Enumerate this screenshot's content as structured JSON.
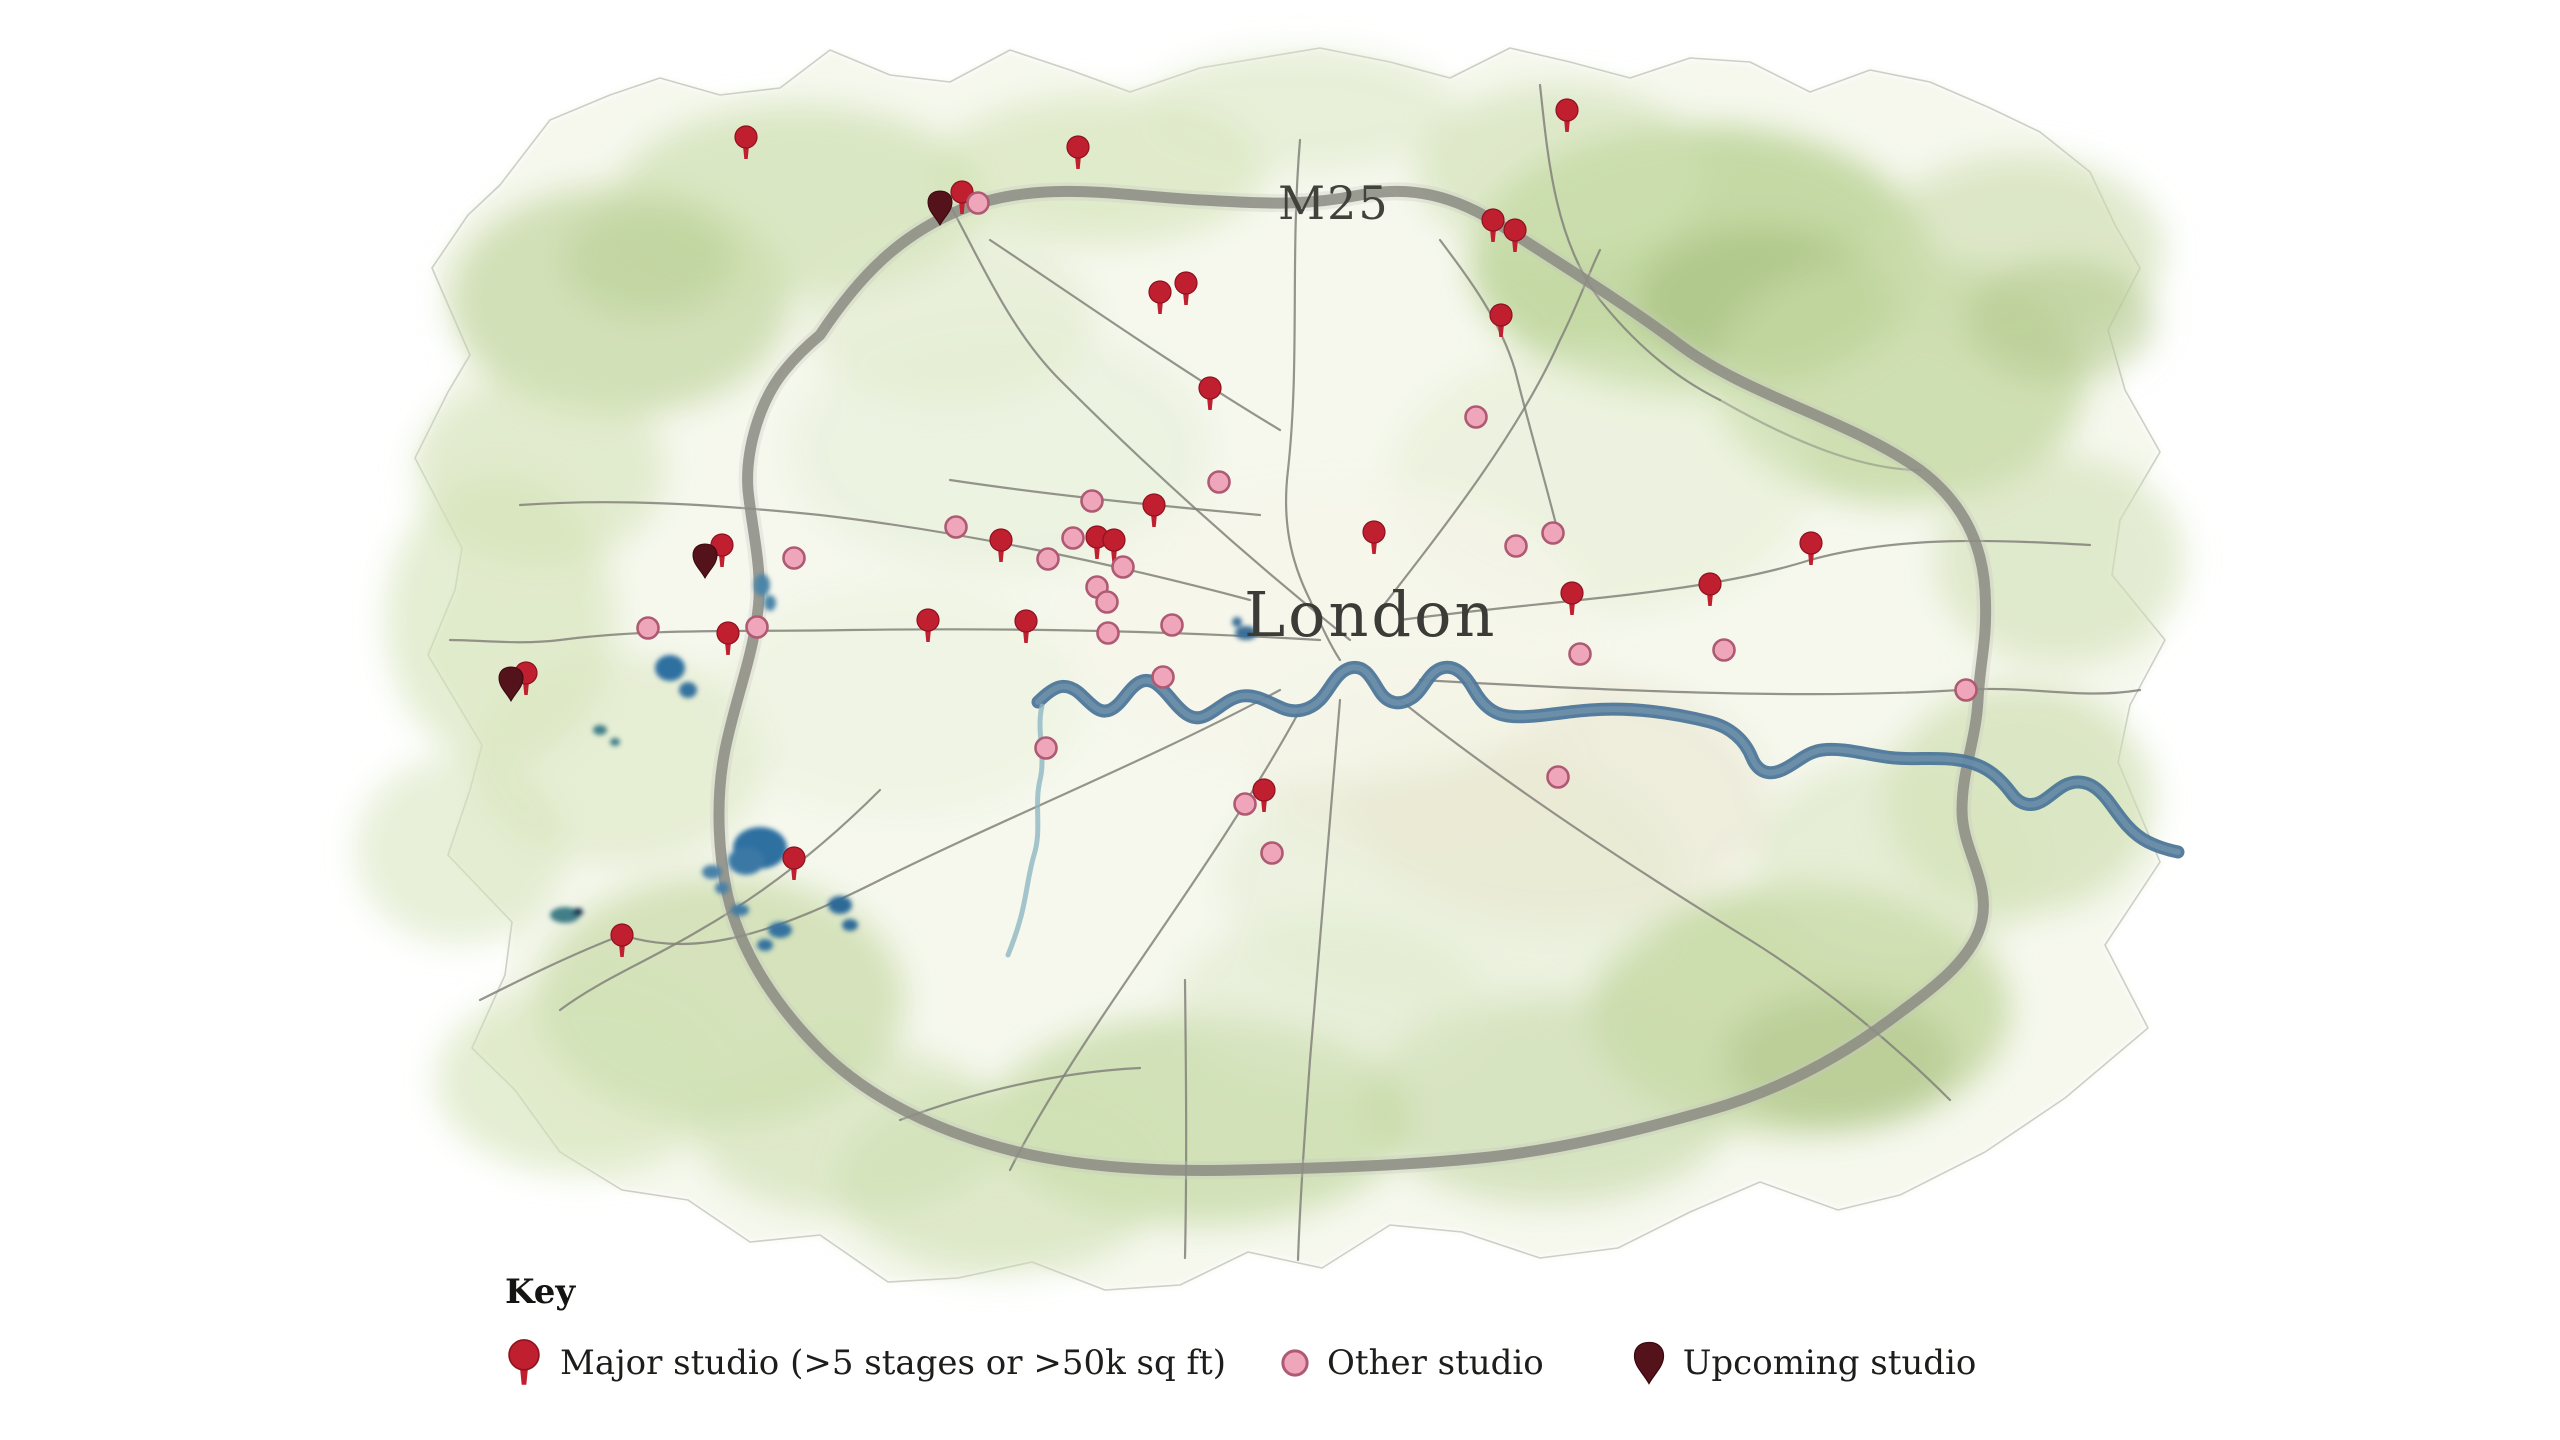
{
  "map": {
    "city_label": "London",
    "motorway_label": "M25",
    "colors": {
      "major": "#bf1f2e",
      "major_edge": "#8e1220",
      "other_fill": "#efa6bb",
      "other_rim": "#ae5a73",
      "upcoming": "#54121a",
      "upcoming_edge": "#38090f",
      "river": "#4d7699",
      "road": "#82817a",
      "land_wash": "#c8daa9",
      "text": "#3a3a35"
    },
    "pins": {
      "major": [
        [
          746,
          137
        ],
        [
          1078,
          147
        ],
        [
          962,
          192
        ],
        [
          1567,
          110
        ],
        [
          1493,
          220
        ],
        [
          1515,
          230
        ],
        [
          1501,
          315
        ],
        [
          1160,
          292
        ],
        [
          1186,
          283
        ],
        [
          1210,
          388
        ],
        [
          1154,
          505
        ],
        [
          1097,
          537
        ],
        [
          1114,
          540
        ],
        [
          1001,
          540
        ],
        [
          1374,
          532
        ],
        [
          1811,
          543
        ],
        [
          1710,
          584
        ],
        [
          1572,
          593
        ],
        [
          928,
          620
        ],
        [
          1026,
          621
        ],
        [
          722,
          545
        ],
        [
          728,
          633
        ],
        [
          526,
          673
        ],
        [
          794,
          858
        ],
        [
          622,
          935
        ],
        [
          1264,
          790
        ]
      ],
      "other": [
        [
          978,
          203
        ],
        [
          1476,
          417
        ],
        [
          1219,
          482
        ],
        [
          1092,
          501
        ],
        [
          956,
          527
        ],
        [
          1073,
          538
        ],
        [
          1048,
          559
        ],
        [
          1123,
          567
        ],
        [
          1097,
          587
        ],
        [
          1107,
          602
        ],
        [
          1108,
          633
        ],
        [
          1172,
          625
        ],
        [
          1163,
          677
        ],
        [
          1553,
          533
        ],
        [
          1516,
          546
        ],
        [
          1580,
          654
        ],
        [
          1724,
          650
        ],
        [
          1966,
          690
        ],
        [
          1046,
          748
        ],
        [
          1558,
          777
        ],
        [
          1245,
          804
        ],
        [
          1272,
          853
        ],
        [
          794,
          558
        ],
        [
          757,
          627
        ],
        [
          648,
          628
        ]
      ],
      "upcoming": [
        [
          940,
          202
        ],
        [
          705,
          555
        ],
        [
          511,
          678
        ]
      ]
    }
  },
  "legend": {
    "heading": "Key",
    "items": [
      {
        "type": "major",
        "label": "Major studio (>5 stages or >50k sq ft)"
      },
      {
        "type": "other",
        "label": "Other studio"
      },
      {
        "type": "upcoming",
        "label": "Upcoming studio"
      }
    ]
  }
}
